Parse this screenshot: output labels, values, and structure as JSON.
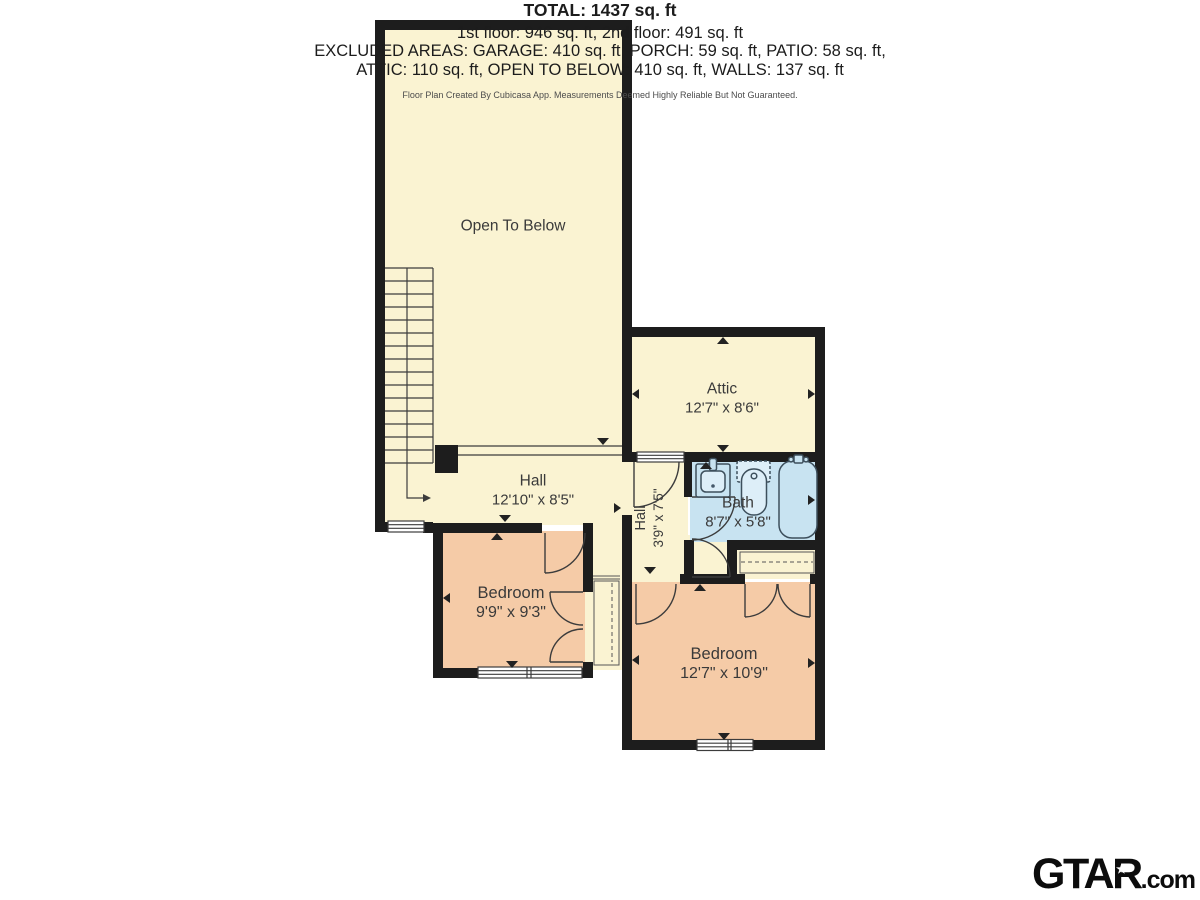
{
  "floor_plan": {
    "colors": {
      "room_yellow": "#faf3d2",
      "room_peach": "#f5cba7",
      "room_blue": "#c8e3f1",
      "wall_black": "#1d1d1d",
      "line_gray": "#3c3c3c"
    },
    "rooms": {
      "open_to_below": {
        "label": "Open To Below"
      },
      "hall_main": {
        "label": "Hall",
        "dims": "12'10\" x 8'5\""
      },
      "attic": {
        "label": "Attic",
        "dims": "12'7\" x 8'6\""
      },
      "hall_small": {
        "label": "Hall",
        "dims": "3'9\" x 7'5\""
      },
      "bath": {
        "label": "Bath",
        "dims": "8'7\" x 5'8\""
      },
      "bedroom_left": {
        "label": "Bedroom",
        "dims": "9'9\" x 9'3\""
      },
      "bedroom_right": {
        "label": "Bedroom",
        "dims": "12'7\" x 10'9\""
      }
    }
  },
  "summary": {
    "total": "TOTAL: 1437 sq. ft",
    "floors": "1st floor: 946 sq. ft, 2nd floor: 491 sq. ft",
    "excluded_1": "EXCLUDED AREAS: GARAGE: 410 sq. ft, PORCH: 59 sq. ft, PATIO: 58 sq. ft,",
    "excluded_2": "ATTIC: 110 sq. ft, OPEN TO BELOW: 410 sq. ft, WALLS: 137 sq. ft",
    "disclaimer": "Floor Plan Created By Cubicasa App. Measurements Deemed Highly Reliable But Not Guaranteed."
  },
  "branding": {
    "logo_main": "GTAR",
    "logo_suffix": ".com",
    "logo_star": "★"
  }
}
